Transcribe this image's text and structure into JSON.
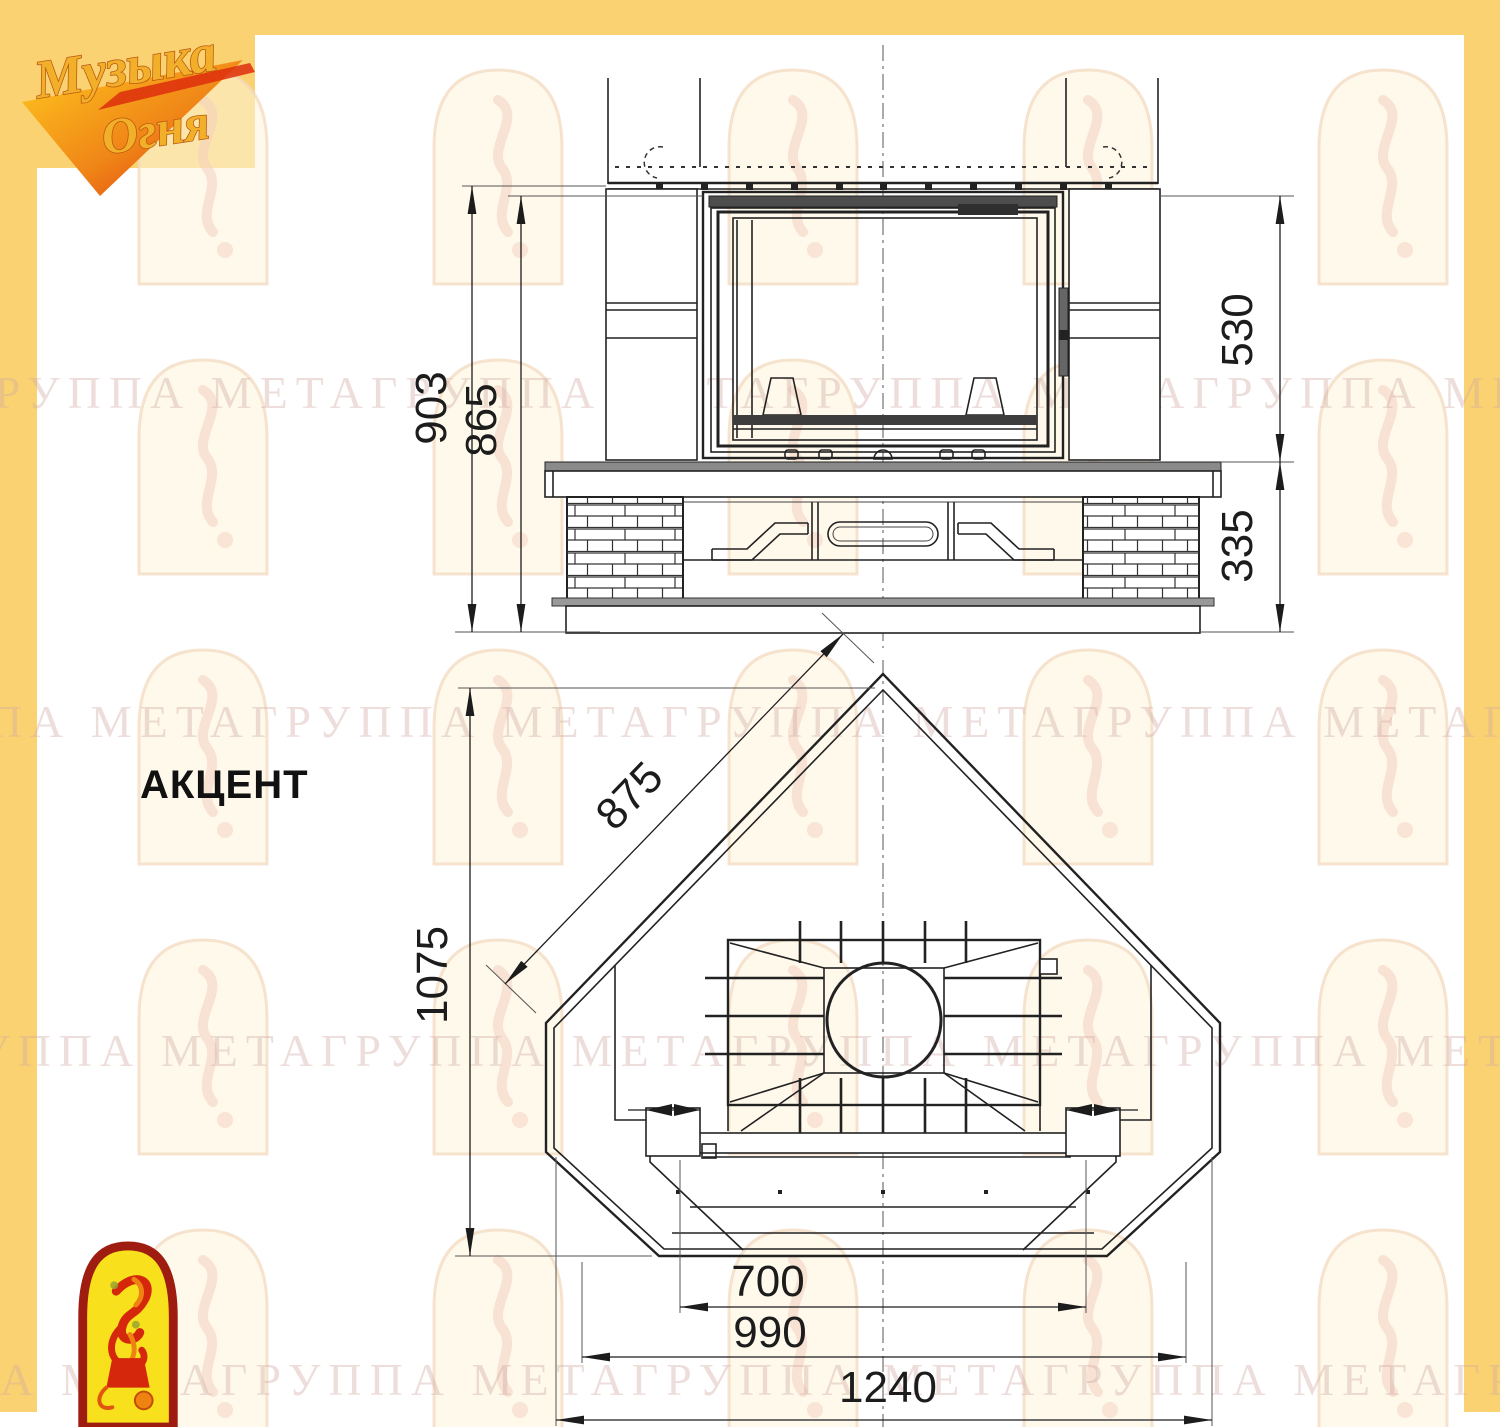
{
  "model_label": "АКЦЕНТ",
  "logo": {
    "line1": "Музыка",
    "line2": "Огня"
  },
  "watermark": {
    "row_text": "ГРУППА МЕТАГРУППА МЕТАГРУППА МЕТАГРУППА МЕТАГРУППА МЕТАГРУППА МЕТА"
  },
  "front_view": {
    "dims": {
      "overall_height": "903",
      "body_height": "865",
      "upper_section_height": "530",
      "base_section_height": "335"
    }
  },
  "plan_view": {
    "dims": {
      "side_edge": "875",
      "total_depth": "1075",
      "firebox_front_width": "700",
      "front_width": "990",
      "overall_width": "1240"
    }
  }
}
